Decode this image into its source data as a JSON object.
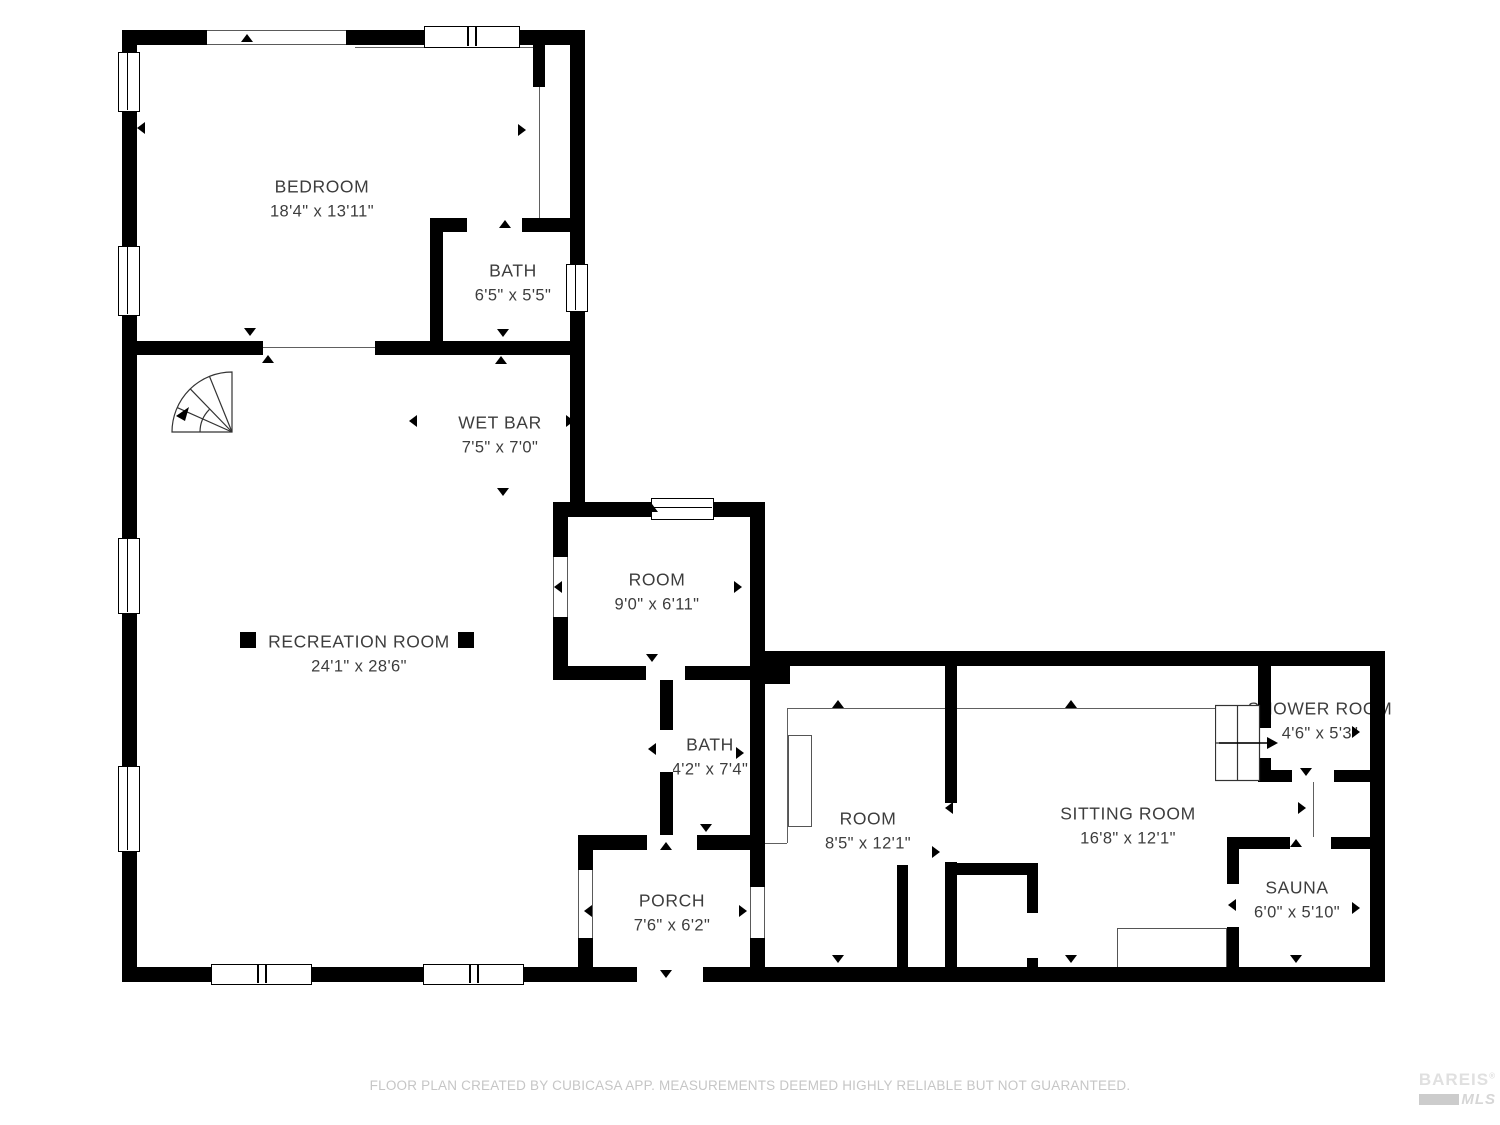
{
  "rooms": [
    {
      "name": "BEDROOM",
      "dims": "18'4\" x 13'11\""
    },
    {
      "name": "BATH",
      "dims": "6'5\" x 5'5\""
    },
    {
      "name": "WET BAR",
      "dims": "7'5\" x 7'0\""
    },
    {
      "name": "RECREATION ROOM",
      "dims": "24'1\" x 28'6\""
    },
    {
      "name": "ROOM",
      "dims": "9'0\" x 6'11\""
    },
    {
      "name": "BATH",
      "dims": "4'2\" x 7'4\""
    },
    {
      "name": "PORCH",
      "dims": "7'6\" x 6'2\""
    },
    {
      "name": "ROOM",
      "dims": "8'5\" x 12'1\""
    },
    {
      "name": "SITTING ROOM",
      "dims": "16'8\" x 12'1\""
    },
    {
      "name": "SHOWER ROOM",
      "dims": "4'6\" x 5'3\""
    },
    {
      "name": "SAUNA",
      "dims": "6'0\" x 5'10\""
    }
  ],
  "footer": {
    "disclaimer": "FLOOR PLAN CREATED BY CUBICASA APP. MEASUREMENTS DEEMED HIGHLY RELIABLE BUT NOT GUARANTEED."
  },
  "logo": {
    "line1": "BAREIS",
    "reg": "®",
    "line2": "MLS"
  },
  "colors": {
    "wall": "#000000",
    "label_text": "#3d3d3d",
    "muted_text": "#c6c6c6"
  }
}
